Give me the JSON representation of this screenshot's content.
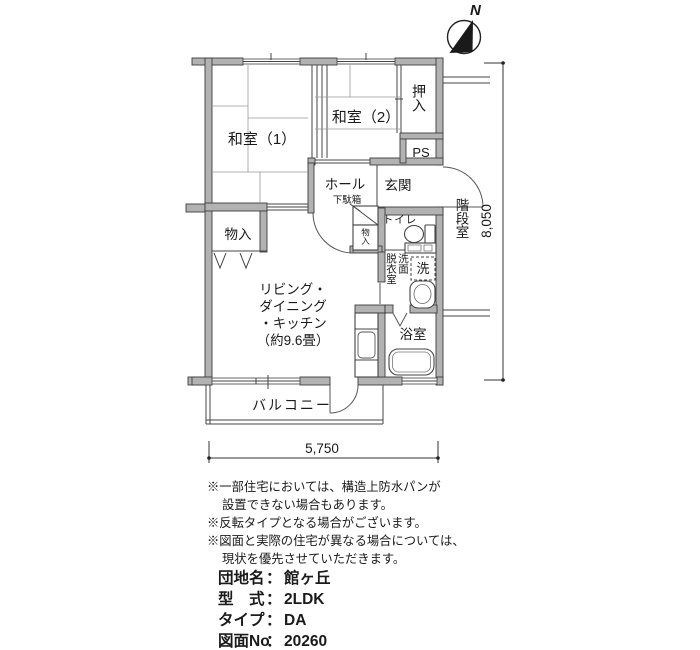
{
  "compass": {
    "north": "N"
  },
  "plan": {
    "rooms": {
      "washitsu1": "和室（1）",
      "washitsu2": "和室（2）",
      "oshiire": "押入",
      "ps": "PS",
      "hall": "ホール",
      "shoe_box": "下駄箱",
      "genkan": "玄関",
      "stairwell": "階段室",
      "toilet": "トイレ",
      "hall_closet": "物入",
      "closet": "物入",
      "dressing_room": "脱衣室",
      "washstand": "洗面",
      "washing_machine": "洗",
      "bath": "浴室",
      "balcony": "バルコニー",
      "ldk_lines": [
        "リビング・",
        "ダイニング",
        "・キッチン",
        "（約9.6畳）"
      ]
    },
    "dimensions": {
      "width": "5,750",
      "height": "8,050"
    }
  },
  "notes": [
    "※一部住宅においては、構造上防水パンが",
    "設置できない場合もあります。",
    "※反転タイプとなる場合がございます。",
    "※図面と実際の住宅が異なる場合については、",
    "現状を優先させていただきます。"
  ],
  "info": {
    "separator": "：",
    "rows": [
      {
        "label": "団地名",
        "value": "館ヶ丘"
      },
      {
        "label": "型　式",
        "value": "2LDK"
      },
      {
        "label": "タイプ",
        "value": "DA"
      },
      {
        "label": "図面No",
        "value": "20260"
      }
    ]
  }
}
